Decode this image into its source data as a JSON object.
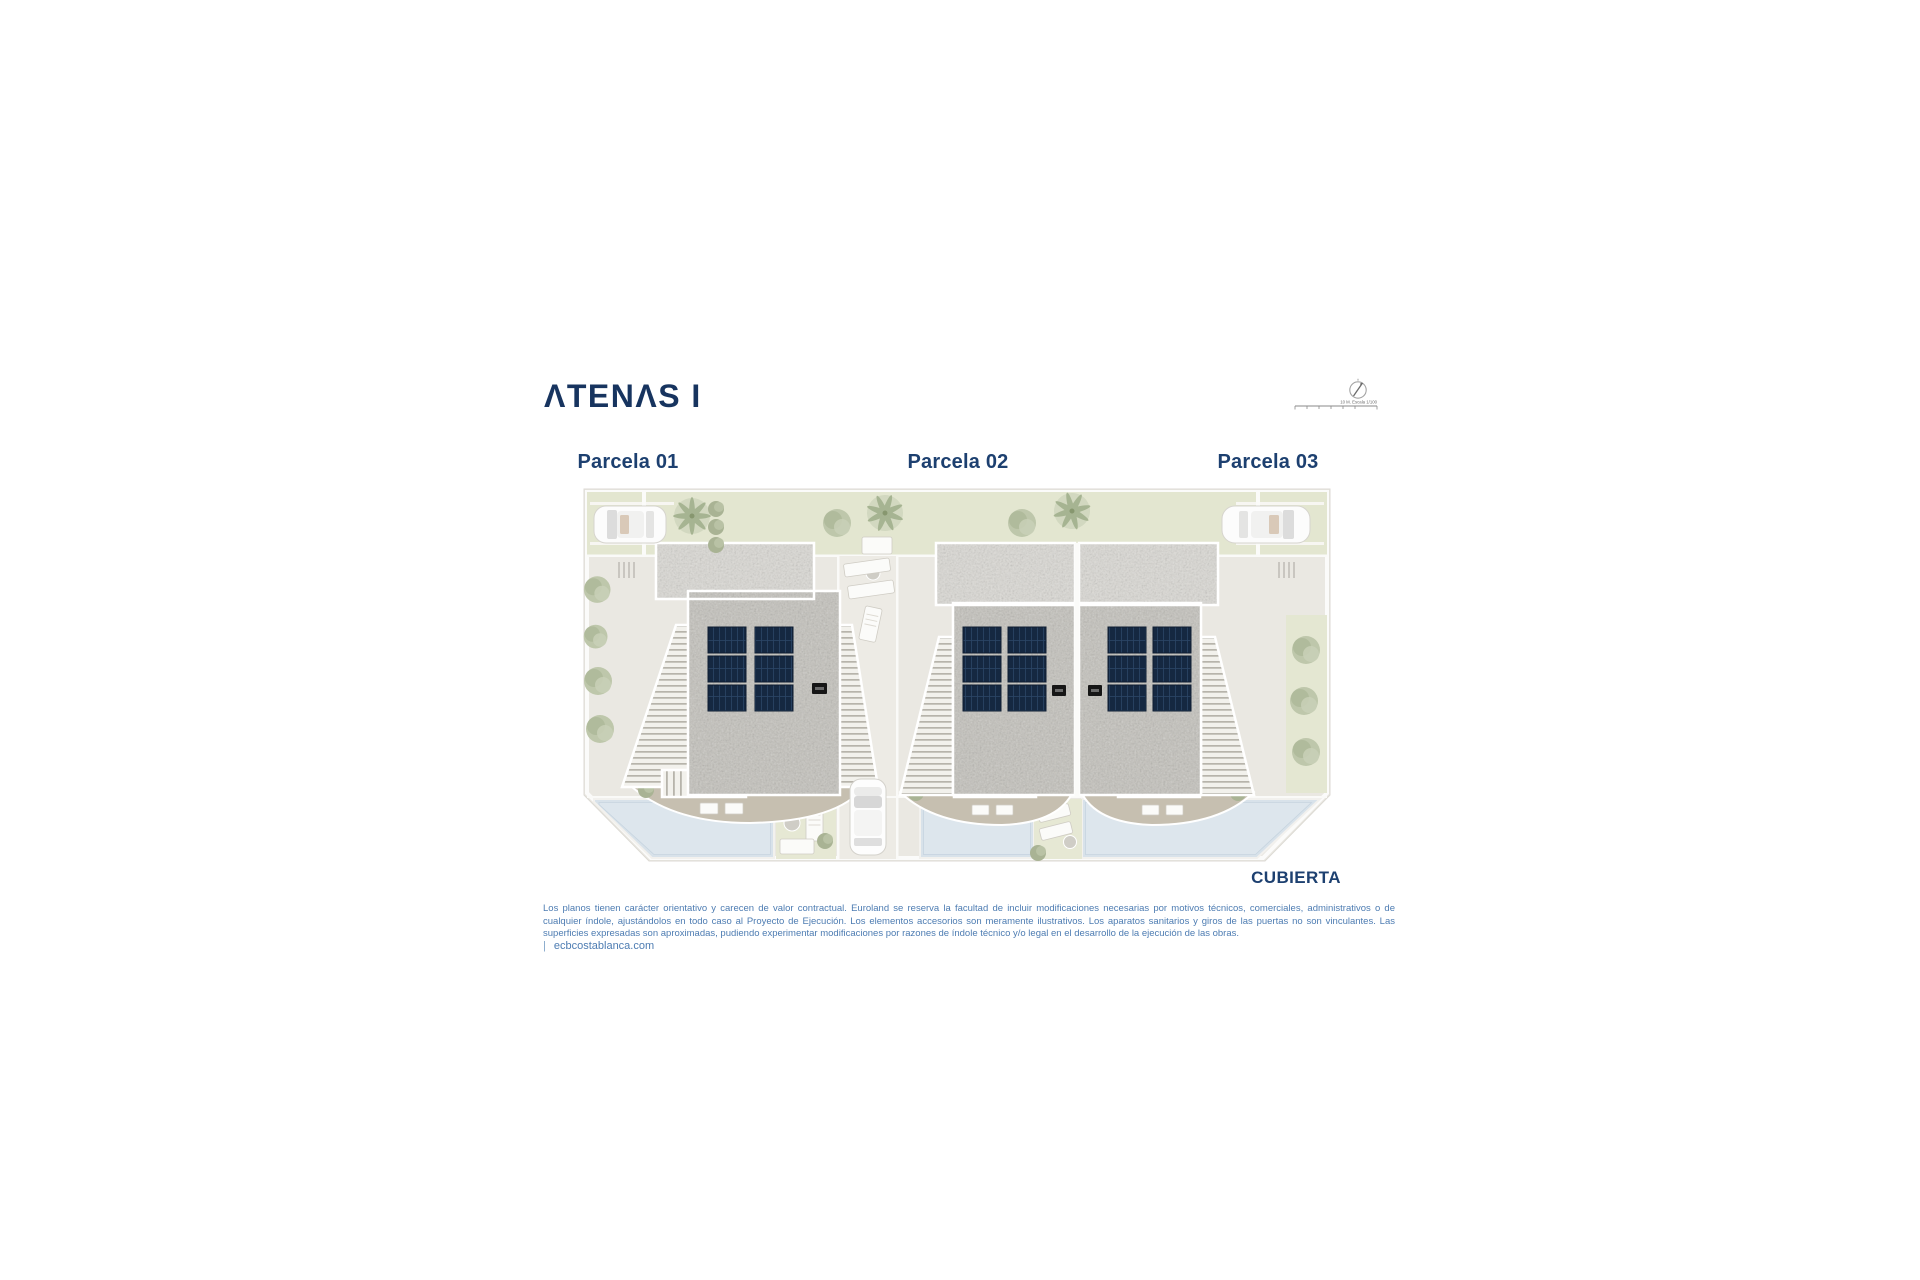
{
  "brand": {
    "title_text": "ATENAS I",
    "title_display": "ΛTENΛS I",
    "color": "#17345f"
  },
  "map_tools": {
    "compass_icon": "north-needle-compass",
    "scale_bar_icon": "graphic-scale-bar",
    "scale_text": "10 M. Escala 1/100"
  },
  "plan": {
    "view_label": "CUBIERTA",
    "parcels": [
      {
        "label": "Parcela 01"
      },
      {
        "label": "Parcela 02"
      },
      {
        "label": "Parcela 03"
      }
    ],
    "features": {
      "solar_panels_per_house": 6,
      "houses": 3,
      "pools": 3,
      "cars": [
        "car-parked-left",
        "car-driveway-center",
        "car-parked-right"
      ]
    }
  },
  "legal": {
    "disclaimer": "Los planos tienen carácter orientativo y carecen de valor contractual. Euroland se reserva la facultad de incluir modificaciones necesarias por motivos técnicos, comerciales, administrativos o de cualquier índole, ajustándolos en todo caso al Proyecto de Ejecución. Los elementos accesorios son meramente ilustrativos. Los aparatos sanitarios y giros de las puertas no son vinculantes. Las superficies expresadas son aproximadas, pudiendo experimentar modificaciones por razones de índole técnico y/o legal en el desarrollo de la ejecución de las obras."
  },
  "footer": {
    "separator": "|",
    "website": "ecbcostablanca.com"
  },
  "colors": {
    "brand_navy": "#1d4070",
    "disclaimer_blue": "#4d7cb2",
    "lawn_green": "#e3e6d0",
    "plan_base": "#eae8e2",
    "roof_gravel": "#c4c2bc",
    "roof_upper": "#dcdad5",
    "solar_panel": "#152841",
    "pool_blue": "#d8e2ea",
    "terrace_taupe": "#c6bfb0",
    "tree_green": "#b3bca0"
  }
}
